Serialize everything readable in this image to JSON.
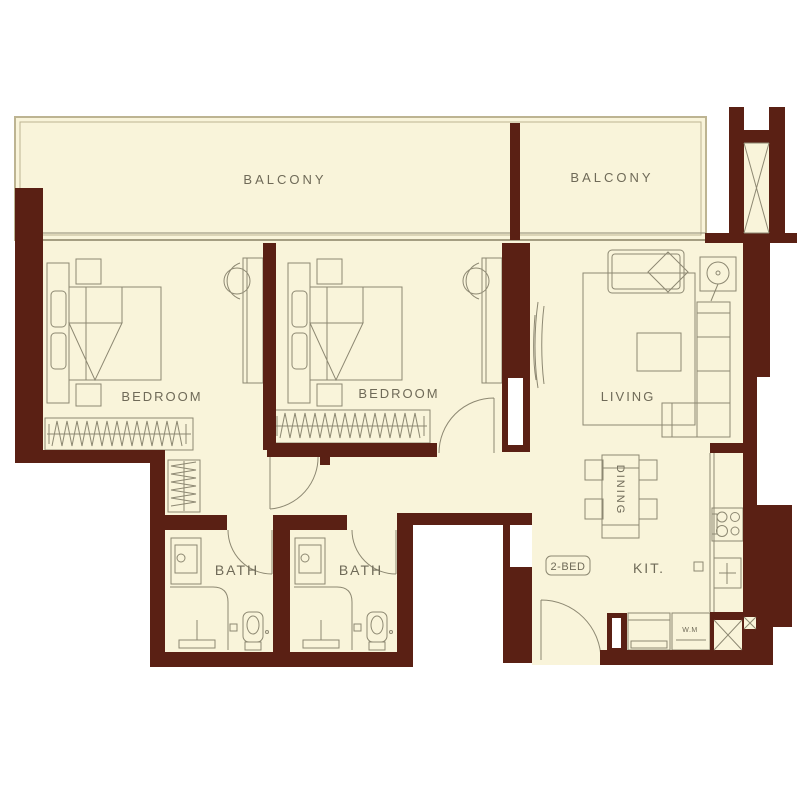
{
  "floorplan": {
    "unit_badge": "2-BED",
    "labels": {
      "balcony_left": "BALCONY",
      "balcony_right": "BALCONY",
      "bedroom_left": "BEDROOM",
      "bedroom_center": "BEDROOM",
      "living": "LIVING",
      "dining": "DINING",
      "kitchen": "KIT.",
      "bath_left": "BATH",
      "bath_right": "BATH",
      "washing_machine": "W.M"
    },
    "colors": {
      "wall": "#5a2014",
      "floor": "#f9f4da",
      "line": "#8d8872",
      "text": "#6f6a58",
      "balcony_border": "#bdb492",
      "background": "#ffffff"
    }
  }
}
